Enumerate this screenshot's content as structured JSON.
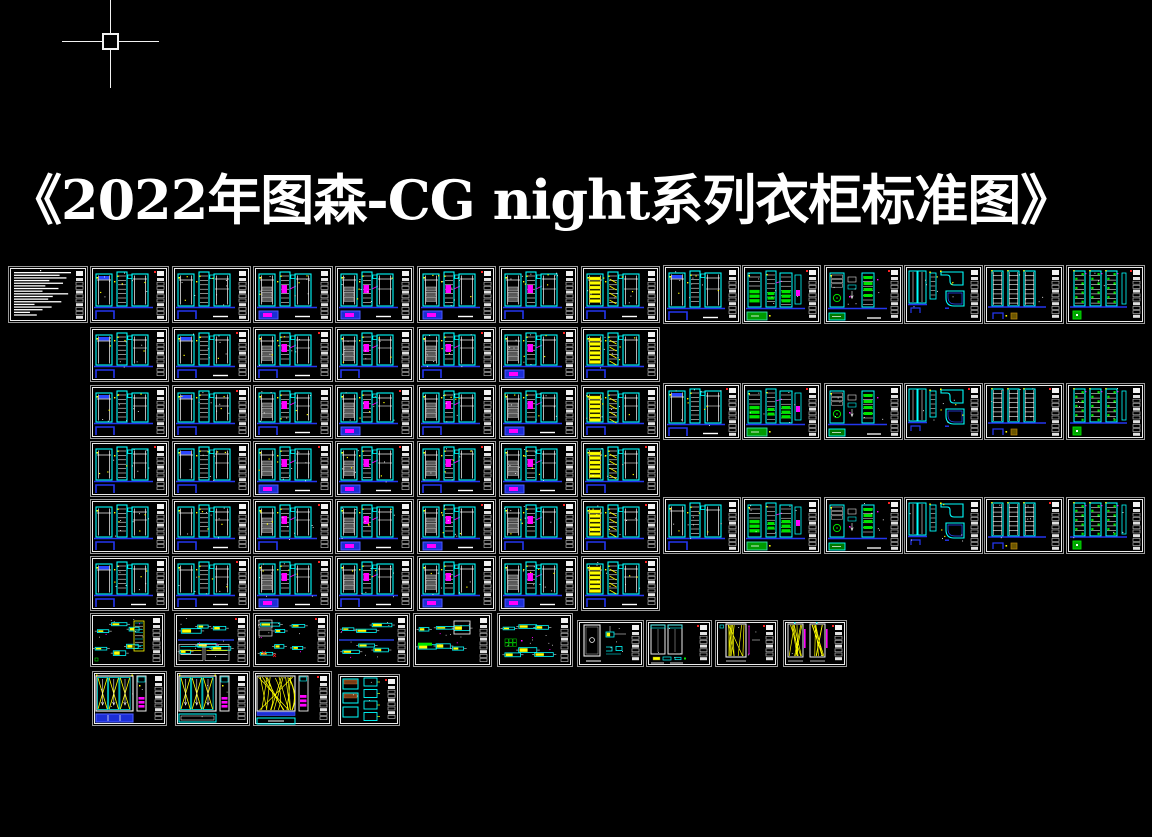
{
  "meta": {
    "app": "cad-drawing-canvas",
    "width": 1152,
    "height": 837,
    "background": "#000000"
  },
  "title": {
    "text": "《2022年图森-CG night系列衣柜标准图》",
    "color": "#ffffff",
    "font_size_px": 54
  },
  "cursor": {
    "x": 110,
    "y": 41,
    "h_from": 62,
    "h_to": 159,
    "v_from": 0,
    "v_to": 88,
    "pickbox_size": 17,
    "color": "#f2f2f2"
  },
  "palette": {
    "background": "#000000",
    "cyan": "#00ffff",
    "blue": "#2436f0",
    "blue_fill": "#1c2ed6",
    "green": "#00e400",
    "green_fill": "#009a00",
    "yellow": "#ffff00",
    "magenta": "#ff00ff",
    "red": "#ff2222",
    "white": "#ffffff",
    "sheet_border": "#9a9a9a",
    "sheet_inner": "#ececec",
    "drawer_gray": "#585858"
  },
  "sheets": [
    {
      "id": "notes-sheet",
      "x": 8,
      "y": 266,
      "w": 80,
      "h": 57,
      "v": "notes",
      "s": 1
    },
    {
      "id": "r1c1",
      "x": 90,
      "y": 266,
      "w": 79,
      "h": 57,
      "v": "ward-a",
      "s": 21
    },
    {
      "id": "r1c2",
      "x": 172,
      "y": 266,
      "w": 79,
      "h": 57,
      "v": "ward-a",
      "s": 22
    },
    {
      "id": "r1c3",
      "x": 253,
      "y": 266,
      "w": 80,
      "h": 57,
      "v": "ward-c",
      "s": 23
    },
    {
      "id": "r1c4",
      "x": 335,
      "y": 266,
      "w": 79,
      "h": 57,
      "v": "ward-c",
      "s": 24
    },
    {
      "id": "r1c5",
      "x": 417,
      "y": 266,
      "w": 79,
      "h": 57,
      "v": "ward-c",
      "s": 25
    },
    {
      "id": "r1c6",
      "x": 499,
      "y": 266,
      "w": 79,
      "h": 57,
      "v": "ward-b",
      "s": 26
    },
    {
      "id": "r1c7",
      "x": 581,
      "y": 266,
      "w": 79,
      "h": 57,
      "v": "ward-y",
      "s": 27
    },
    {
      "id": "r1c8",
      "x": 663,
      "y": 265,
      "w": 78,
      "h": 59,
      "v": "ward-a",
      "s": 28
    },
    {
      "id": "r1c9",
      "x": 742,
      "y": 265,
      "w": 79,
      "h": 59,
      "v": "ward-g",
      "s": 29
    },
    {
      "id": "r1c10",
      "x": 824,
      "y": 265,
      "w": 79,
      "h": 59,
      "v": "ward-gc",
      "s": 30
    },
    {
      "id": "r1c11",
      "x": 904,
      "y": 265,
      "w": 79,
      "h": 59,
      "v": "corner",
      "s": 31
    },
    {
      "id": "r1c12",
      "x": 984,
      "y": 265,
      "w": 80,
      "h": 59,
      "v": "ladders",
      "s": 32
    },
    {
      "id": "r1c13",
      "x": 1066,
      "y": 265,
      "w": 79,
      "h": 59,
      "v": "ladders-green",
      "s": 33
    },
    {
      "id": "r2c1",
      "x": 90,
      "y": 327,
      "w": 79,
      "h": 55,
      "v": "ward-a",
      "s": 41
    },
    {
      "id": "r2c2",
      "x": 172,
      "y": 327,
      "w": 79,
      "h": 55,
      "v": "ward-a",
      "s": 42
    },
    {
      "id": "r2c3",
      "x": 253,
      "y": 327,
      "w": 80,
      "h": 55,
      "v": "ward-b",
      "s": 43
    },
    {
      "id": "r2c4",
      "x": 335,
      "y": 327,
      "w": 79,
      "h": 55,
      "v": "ward-b",
      "s": 44
    },
    {
      "id": "r2c5",
      "x": 417,
      "y": 327,
      "w": 79,
      "h": 55,
      "v": "ward-b",
      "s": 45
    },
    {
      "id": "r2c6",
      "x": 499,
      "y": 327,
      "w": 79,
      "h": 55,
      "v": "ward-c",
      "s": 46
    },
    {
      "id": "r2c7",
      "x": 581,
      "y": 327,
      "w": 79,
      "h": 55,
      "v": "ward-y",
      "s": 47
    },
    {
      "id": "r3c1",
      "x": 90,
      "y": 385,
      "w": 79,
      "h": 54,
      "v": "ward-a",
      "s": 51
    },
    {
      "id": "r3c2",
      "x": 172,
      "y": 385,
      "w": 79,
      "h": 54,
      "v": "ward-a",
      "s": 52
    },
    {
      "id": "r3c3",
      "x": 253,
      "y": 385,
      "w": 80,
      "h": 54,
      "v": "ward-b",
      "s": 53
    },
    {
      "id": "r3c4",
      "x": 335,
      "y": 385,
      "w": 79,
      "h": 54,
      "v": "ward-c",
      "s": 54
    },
    {
      "id": "r3c5",
      "x": 417,
      "y": 385,
      "w": 79,
      "h": 54,
      "v": "ward-b",
      "s": 55
    },
    {
      "id": "r3c6",
      "x": 499,
      "y": 385,
      "w": 79,
      "h": 54,
      "v": "ward-c",
      "s": 56
    },
    {
      "id": "r3c7",
      "x": 581,
      "y": 385,
      "w": 79,
      "h": 54,
      "v": "ward-y",
      "s": 57
    },
    {
      "id": "r3c8",
      "x": 663,
      "y": 383,
      "w": 78,
      "h": 57,
      "v": "ward-a",
      "s": 58
    },
    {
      "id": "r3c9",
      "x": 742,
      "y": 383,
      "w": 79,
      "h": 57,
      "v": "ward-g",
      "s": 59
    },
    {
      "id": "r3c10",
      "x": 824,
      "y": 383,
      "w": 79,
      "h": 57,
      "v": "ward-gc",
      "s": 60
    },
    {
      "id": "r3c11",
      "x": 904,
      "y": 383,
      "w": 79,
      "h": 57,
      "v": "corner",
      "s": 61
    },
    {
      "id": "r3c12",
      "x": 984,
      "y": 383,
      "w": 80,
      "h": 57,
      "v": "ladders",
      "s": 62
    },
    {
      "id": "r3c13",
      "x": 1066,
      "y": 383,
      "w": 79,
      "h": 57,
      "v": "ladders-green",
      "s": 63
    },
    {
      "id": "r4c1",
      "x": 90,
      "y": 441,
      "w": 79,
      "h": 56,
      "v": "ward-a",
      "s": 71
    },
    {
      "id": "r4c2",
      "x": 172,
      "y": 441,
      "w": 79,
      "h": 56,
      "v": "ward-a",
      "s": 72
    },
    {
      "id": "r4c3",
      "x": 253,
      "y": 441,
      "w": 80,
      "h": 56,
      "v": "ward-c",
      "s": 73
    },
    {
      "id": "r4c4",
      "x": 335,
      "y": 441,
      "w": 79,
      "h": 56,
      "v": "ward-c",
      "s": 74
    },
    {
      "id": "r4c5",
      "x": 417,
      "y": 441,
      "w": 79,
      "h": 56,
      "v": "ward-b",
      "s": 75
    },
    {
      "id": "r4c6",
      "x": 499,
      "y": 441,
      "w": 79,
      "h": 56,
      "v": "ward-c",
      "s": 76
    },
    {
      "id": "r4c7",
      "x": 581,
      "y": 441,
      "w": 79,
      "h": 56,
      "v": "ward-y",
      "s": 77
    },
    {
      "id": "r5c1",
      "x": 90,
      "y": 499,
      "w": 79,
      "h": 55,
      "v": "ward-a",
      "s": 81
    },
    {
      "id": "r5c2",
      "x": 172,
      "y": 499,
      "w": 79,
      "h": 55,
      "v": "ward-a",
      "s": 82
    },
    {
      "id": "r5c3",
      "x": 253,
      "y": 499,
      "w": 80,
      "h": 55,
      "v": "ward-b",
      "s": 83
    },
    {
      "id": "r5c4",
      "x": 335,
      "y": 499,
      "w": 79,
      "h": 55,
      "v": "ward-c",
      "s": 84
    },
    {
      "id": "r5c5",
      "x": 417,
      "y": 499,
      "w": 79,
      "h": 55,
      "v": "ward-c",
      "s": 85
    },
    {
      "id": "r5c6",
      "x": 499,
      "y": 499,
      "w": 79,
      "h": 55,
      "v": "ward-b",
      "s": 86
    },
    {
      "id": "r5c7",
      "x": 581,
      "y": 499,
      "w": 79,
      "h": 55,
      "v": "ward-y",
      "s": 87
    },
    {
      "id": "r5c8",
      "x": 663,
      "y": 497,
      "w": 78,
      "h": 57,
      "v": "ward-a",
      "s": 88
    },
    {
      "id": "r5c9",
      "x": 742,
      "y": 497,
      "w": 79,
      "h": 57,
      "v": "ward-g",
      "s": 89
    },
    {
      "id": "r5c10",
      "x": 824,
      "y": 497,
      "w": 79,
      "h": 57,
      "v": "ward-gc",
      "s": 90
    },
    {
      "id": "r5c11",
      "x": 904,
      "y": 497,
      "w": 79,
      "h": 57,
      "v": "corner",
      "s": 91
    },
    {
      "id": "r5c12",
      "x": 984,
      "y": 497,
      "w": 80,
      "h": 57,
      "v": "ladders",
      "s": 92
    },
    {
      "id": "r5c13",
      "x": 1066,
      "y": 497,
      "w": 79,
      "h": 57,
      "v": "ladders-green",
      "s": 93
    },
    {
      "id": "r6c1",
      "x": 90,
      "y": 556,
      "w": 79,
      "h": 55,
      "v": "ward-a",
      "s": 101
    },
    {
      "id": "r6c2",
      "x": 172,
      "y": 556,
      "w": 79,
      "h": 55,
      "v": "ward-a",
      "s": 102
    },
    {
      "id": "r6c3",
      "x": 253,
      "y": 556,
      "w": 80,
      "h": 55,
      "v": "ward-c",
      "s": 103
    },
    {
      "id": "r6c4",
      "x": 335,
      "y": 556,
      "w": 79,
      "h": 55,
      "v": "ward-b",
      "s": 104
    },
    {
      "id": "r6c5",
      "x": 417,
      "y": 556,
      "w": 79,
      "h": 55,
      "v": "ward-c",
      "s": 105
    },
    {
      "id": "r6c6",
      "x": 499,
      "y": 556,
      "w": 79,
      "h": 55,
      "v": "ward-c",
      "s": 106
    },
    {
      "id": "r6c7",
      "x": 581,
      "y": 556,
      "w": 79,
      "h": 55,
      "v": "ward-y",
      "s": 107
    },
    {
      "id": "det-1",
      "x": 90,
      "y": 613,
      "w": 75,
      "h": 54,
      "v": "detail-1",
      "s": 111
    },
    {
      "id": "det-2",
      "x": 174,
      "y": 613,
      "w": 76,
      "h": 54,
      "v": "detail-2",
      "s": 112
    },
    {
      "id": "det-3",
      "x": 253,
      "y": 613,
      "w": 77,
      "h": 54,
      "v": "detail-3",
      "s": 113
    },
    {
      "id": "det-4",
      "x": 335,
      "y": 613,
      "w": 75,
      "h": 54,
      "v": "detail-4",
      "s": 114
    },
    {
      "id": "det-5",
      "x": 413,
      "y": 613,
      "w": 79,
      "h": 54,
      "v": "detail-5",
      "s": 115
    },
    {
      "id": "det-6",
      "x": 497,
      "y": 613,
      "w": 76,
      "h": 54,
      "v": "detail-6",
      "s": 116
    },
    {
      "id": "door-a",
      "x": 577,
      "y": 620,
      "w": 67,
      "h": 47,
      "v": "door-single",
      "s": 121
    },
    {
      "id": "door-b",
      "x": 646,
      "y": 620,
      "w": 66,
      "h": 47,
      "v": "door-double",
      "s": 122
    },
    {
      "id": "door-c",
      "x": 715,
      "y": 620,
      "w": 63,
      "h": 47,
      "v": "door-x1",
      "s": 123
    },
    {
      "id": "door-d",
      "x": 783,
      "y": 620,
      "w": 64,
      "h": 47,
      "v": "door-x2",
      "s": 124
    },
    {
      "id": "elev-a",
      "x": 92,
      "y": 671,
      "w": 75,
      "h": 55,
      "v": "doors-x3",
      "s": 131
    },
    {
      "id": "elev-b",
      "x": 175,
      "y": 671,
      "w": 75,
      "h": 55,
      "v": "doors-x3b",
      "s": 132
    },
    {
      "id": "elev-c",
      "x": 253,
      "y": 671,
      "w": 79,
      "h": 55,
      "v": "doors-dense",
      "s": 133
    },
    {
      "id": "elev-d",
      "x": 338,
      "y": 674,
      "w": 62,
      "h": 52,
      "v": "parts-grid",
      "s": 134
    }
  ]
}
